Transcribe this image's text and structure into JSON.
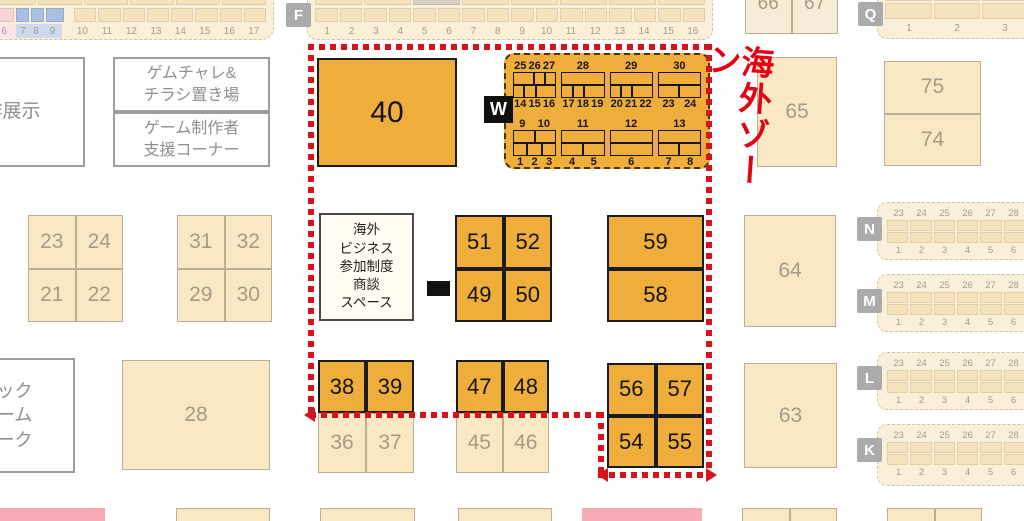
{
  "title": "海外ゾーン",
  "colors": {
    "zone_red": "#e60012",
    "booth_orange": "#efae3c",
    "booth_tan": "#f8e8c3",
    "highlight_pink": "#f6d3d8",
    "highlight_blue": "#a9c0e2"
  },
  "section_labels": {
    "f": "F",
    "q": "Q",
    "w": "W",
    "n": "N",
    "m": "M",
    "l": "L",
    "k": "K"
  },
  "strips": {
    "top_left": {
      "items": [
        {
          "n": "6",
          "w": 1.5,
          "c": "pink"
        },
        {
          "n": "7",
          "w": 0.8,
          "c": "blue"
        },
        {
          "n": "8",
          "w": 0.8,
          "c": "blue"
        },
        {
          "n": "9",
          "w": 1.2,
          "c": "blue",
          "gap": true
        },
        {
          "n": "10",
          "w": 1.5
        },
        {
          "n": "11",
          "w": 1.5
        },
        {
          "n": "12",
          "w": 1.5
        },
        {
          "n": "13",
          "w": 1.5
        },
        {
          "n": "14",
          "w": 1.5
        },
        {
          "n": "15",
          "w": 1.5
        },
        {
          "n": "16",
          "w": 1.5
        },
        {
          "n": "17",
          "w": 1.5
        }
      ]
    },
    "f": {
      "numbers": [
        "1",
        "2",
        "3",
        "4",
        "5",
        "6",
        "7",
        "8",
        "9",
        "10",
        "11",
        "12",
        "13",
        "14",
        "15",
        "16"
      ]
    },
    "q": {
      "numbers": [
        "1",
        "2",
        "3"
      ]
    },
    "right": {
      "top_numbers": [
        "23",
        "24",
        "25",
        "26",
        "27",
        "28"
      ],
      "bottom_numbers": [
        "1",
        "2",
        "3",
        "4",
        "5",
        "6"
      ]
    }
  },
  "info_boxes": {
    "new_work": "新作展示",
    "gamechalle": [
      "ゲムチャレ&",
      "チラシ置き場"
    ],
    "support": [
      "ゲーム制作者",
      "支援コーナー"
    ],
    "big_game_park": [
      "ビック",
      "ゲーム",
      "パーク"
    ],
    "biz_space": [
      "海外",
      "ビジネス",
      "参加制度",
      "商談",
      "スペース"
    ]
  },
  "booths": {
    "b40": "40",
    "b28": "28",
    "b65": "65",
    "b64": "64",
    "b63": "63",
    "b75": "75",
    "b74": "74",
    "b66": "66",
    "b67": "67",
    "b59": "59",
    "b58": "58",
    "grid_2324": [
      "23",
      "24",
      "21",
      "22"
    ],
    "grid_3132": [
      "31",
      "32",
      "29",
      "30"
    ],
    "grid_5152": [
      "51",
      "52",
      "49",
      "50"
    ],
    "grid_5657": [
      "56",
      "57",
      "54",
      "55"
    ],
    "row_3839": [
      "38",
      "39"
    ],
    "row_3637": [
      "36",
      "37"
    ],
    "row_4748": [
      "47",
      "48"
    ],
    "row_4546": [
      "45",
      "46"
    ]
  },
  "overseas_grid": {
    "blocks": [
      {
        "groups": [
          {
            "top": [
              "25",
              "26",
              "27"
            ],
            "top_cells": [
              2,
              1,
              1
            ],
            "bottom_cells": [
              1,
              1,
              2
            ],
            "bottom": [
              "14",
              "15",
              "16"
            ]
          },
          {
            "top": [
              "28"
            ],
            "top_cells": [
              1
            ],
            "bottom_cells": [
              1,
              1,
              2
            ],
            "bottom": [
              "17",
              "18",
              "19"
            ]
          },
          {
            "top": [
              "29"
            ],
            "top_cells": [
              1
            ],
            "bottom_cells": [
              1,
              1,
              2
            ],
            "bottom": [
              "20",
              "21",
              "22"
            ]
          },
          {
            "top": [
              "30"
            ],
            "top_cells": [
              1
            ],
            "bottom_cells": [
              1,
              1
            ],
            "bottom": [
              "23",
              "24"
            ]
          }
        ]
      },
      {
        "groups": [
          {
            "top": [
              "9",
              "10"
            ],
            "top_cells": [
              1,
              1
            ],
            "bottom_cells": [
              1,
              1,
              1
            ],
            "bottom": [
              "1",
              "2",
              "3"
            ]
          },
          {
            "top": [
              "11"
            ],
            "top_cells": [
              1
            ],
            "bottom_cells": [
              1,
              1
            ],
            "bottom": [
              "4",
              "5"
            ]
          },
          {
            "top": [
              "12"
            ],
            "top_cells": [
              1
            ],
            "bottom_cells": [
              1
            ],
            "bottom": [
              "6"
            ]
          },
          {
            "top": [
              "13"
            ],
            "top_cells": [
              1
            ],
            "bottom_cells": [
              1,
              1
            ],
            "bottom": [
              "7",
              "8"
            ]
          }
        ]
      }
    ]
  }
}
